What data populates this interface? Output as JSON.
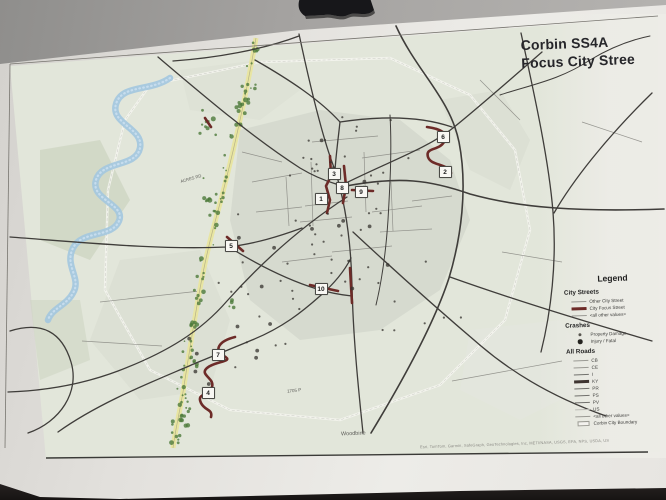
{
  "photo": {
    "icons": {
      "clip": "binder-clip"
    }
  },
  "map": {
    "title_line1": "Corbin SS4A",
    "title_line2": "Focus City Stree",
    "attribution": "Esri, TomTom, Garmin, SafeGraph, GeoTechnologies, Inc, METI/NASA, USGS, EPA, NPS, USDA, US",
    "colors": {
      "focus_street": "#6d2b28",
      "river": "#a3c6df",
      "corridor": "#e8e5a2",
      "trees": "#4d7a3b",
      "terrain": "#e2e6da"
    },
    "markers": [
      {
        "num": "1",
        "x": 320,
        "y": 198
      },
      {
        "num": "2",
        "x": 444,
        "y": 171
      },
      {
        "num": "3",
        "x": 333,
        "y": 173
      },
      {
        "num": "4",
        "x": 207,
        "y": 392
      },
      {
        "num": "5",
        "x": 230,
        "y": 245
      },
      {
        "num": "6",
        "x": 442,
        "y": 136
      },
      {
        "num": "7",
        "x": 217,
        "y": 354
      },
      {
        "num": "8",
        "x": 341,
        "y": 187
      },
      {
        "num": "9",
        "x": 360,
        "y": 191
      },
      {
        "num": "10",
        "x": 320,
        "y": 288
      }
    ],
    "labels": [
      {
        "text": "Woodbine",
        "x": 341,
        "y": 431,
        "rot": -2,
        "size": 5.5
      },
      {
        "text": "1705 P",
        "x": 287,
        "y": 388,
        "rot": -6,
        "size": 4.5
      },
      {
        "text": "ACRES RD",
        "x": 180,
        "y": 176,
        "rot": -16,
        "size": 4.2
      }
    ],
    "legend": {
      "title": "Legend",
      "sections": [
        {
          "heading": "City Streets",
          "items": [
            {
              "label": "Other City Street",
              "swatch": "line-thin"
            },
            {
              "label": "City Focus Street",
              "swatch": "line-focus"
            },
            {
              "label": "<all other values>",
              "swatch": "line-thin"
            }
          ]
        },
        {
          "heading": "Crashes",
          "items": [
            {
              "label": "Property Damage",
              "swatch": "dot-small"
            },
            {
              "label": "Injury / Fatal",
              "swatch": "dot-large"
            }
          ]
        },
        {
          "heading": "All Roads",
          "items": [
            {
              "label": "CB",
              "swatch": "line-thin"
            },
            {
              "label": "CE",
              "swatch": "line-thin"
            },
            {
              "label": "I",
              "swatch": "line-med"
            },
            {
              "label": "KY",
              "swatch": "line-ky"
            },
            {
              "label": "PR",
              "swatch": "line-med"
            },
            {
              "label": "PS",
              "swatch": "line-med"
            },
            {
              "label": "PV",
              "swatch": "line-med"
            },
            {
              "label": "US",
              "swatch": "line-light"
            },
            {
              "label": "<all other values>",
              "swatch": "line-thin"
            },
            {
              "label": "Corbin City Boundary",
              "swatch": "rect-boundary"
            }
          ]
        }
      ]
    }
  }
}
